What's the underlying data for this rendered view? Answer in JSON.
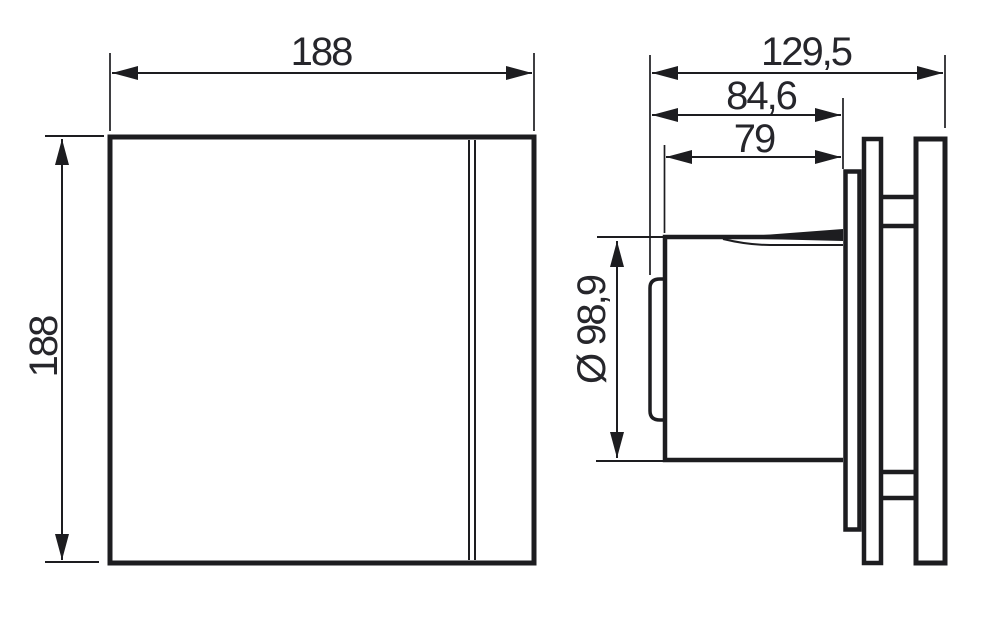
{
  "drawing": {
    "description": "Dimensional technical drawing of an extractor fan, front view and side view",
    "units": "mm",
    "colors": {
      "line": "#1d1d20",
      "text": "#26262b",
      "background": "#ffffff"
    },
    "front_view": {
      "width_label": "188",
      "height_label": "188"
    },
    "side_view": {
      "overall_depth_label": "129,5",
      "depth_to_wall_label": "84,6",
      "insert_depth_label": "79",
      "duct_diameter_label": "Ø 98,9"
    }
  }
}
